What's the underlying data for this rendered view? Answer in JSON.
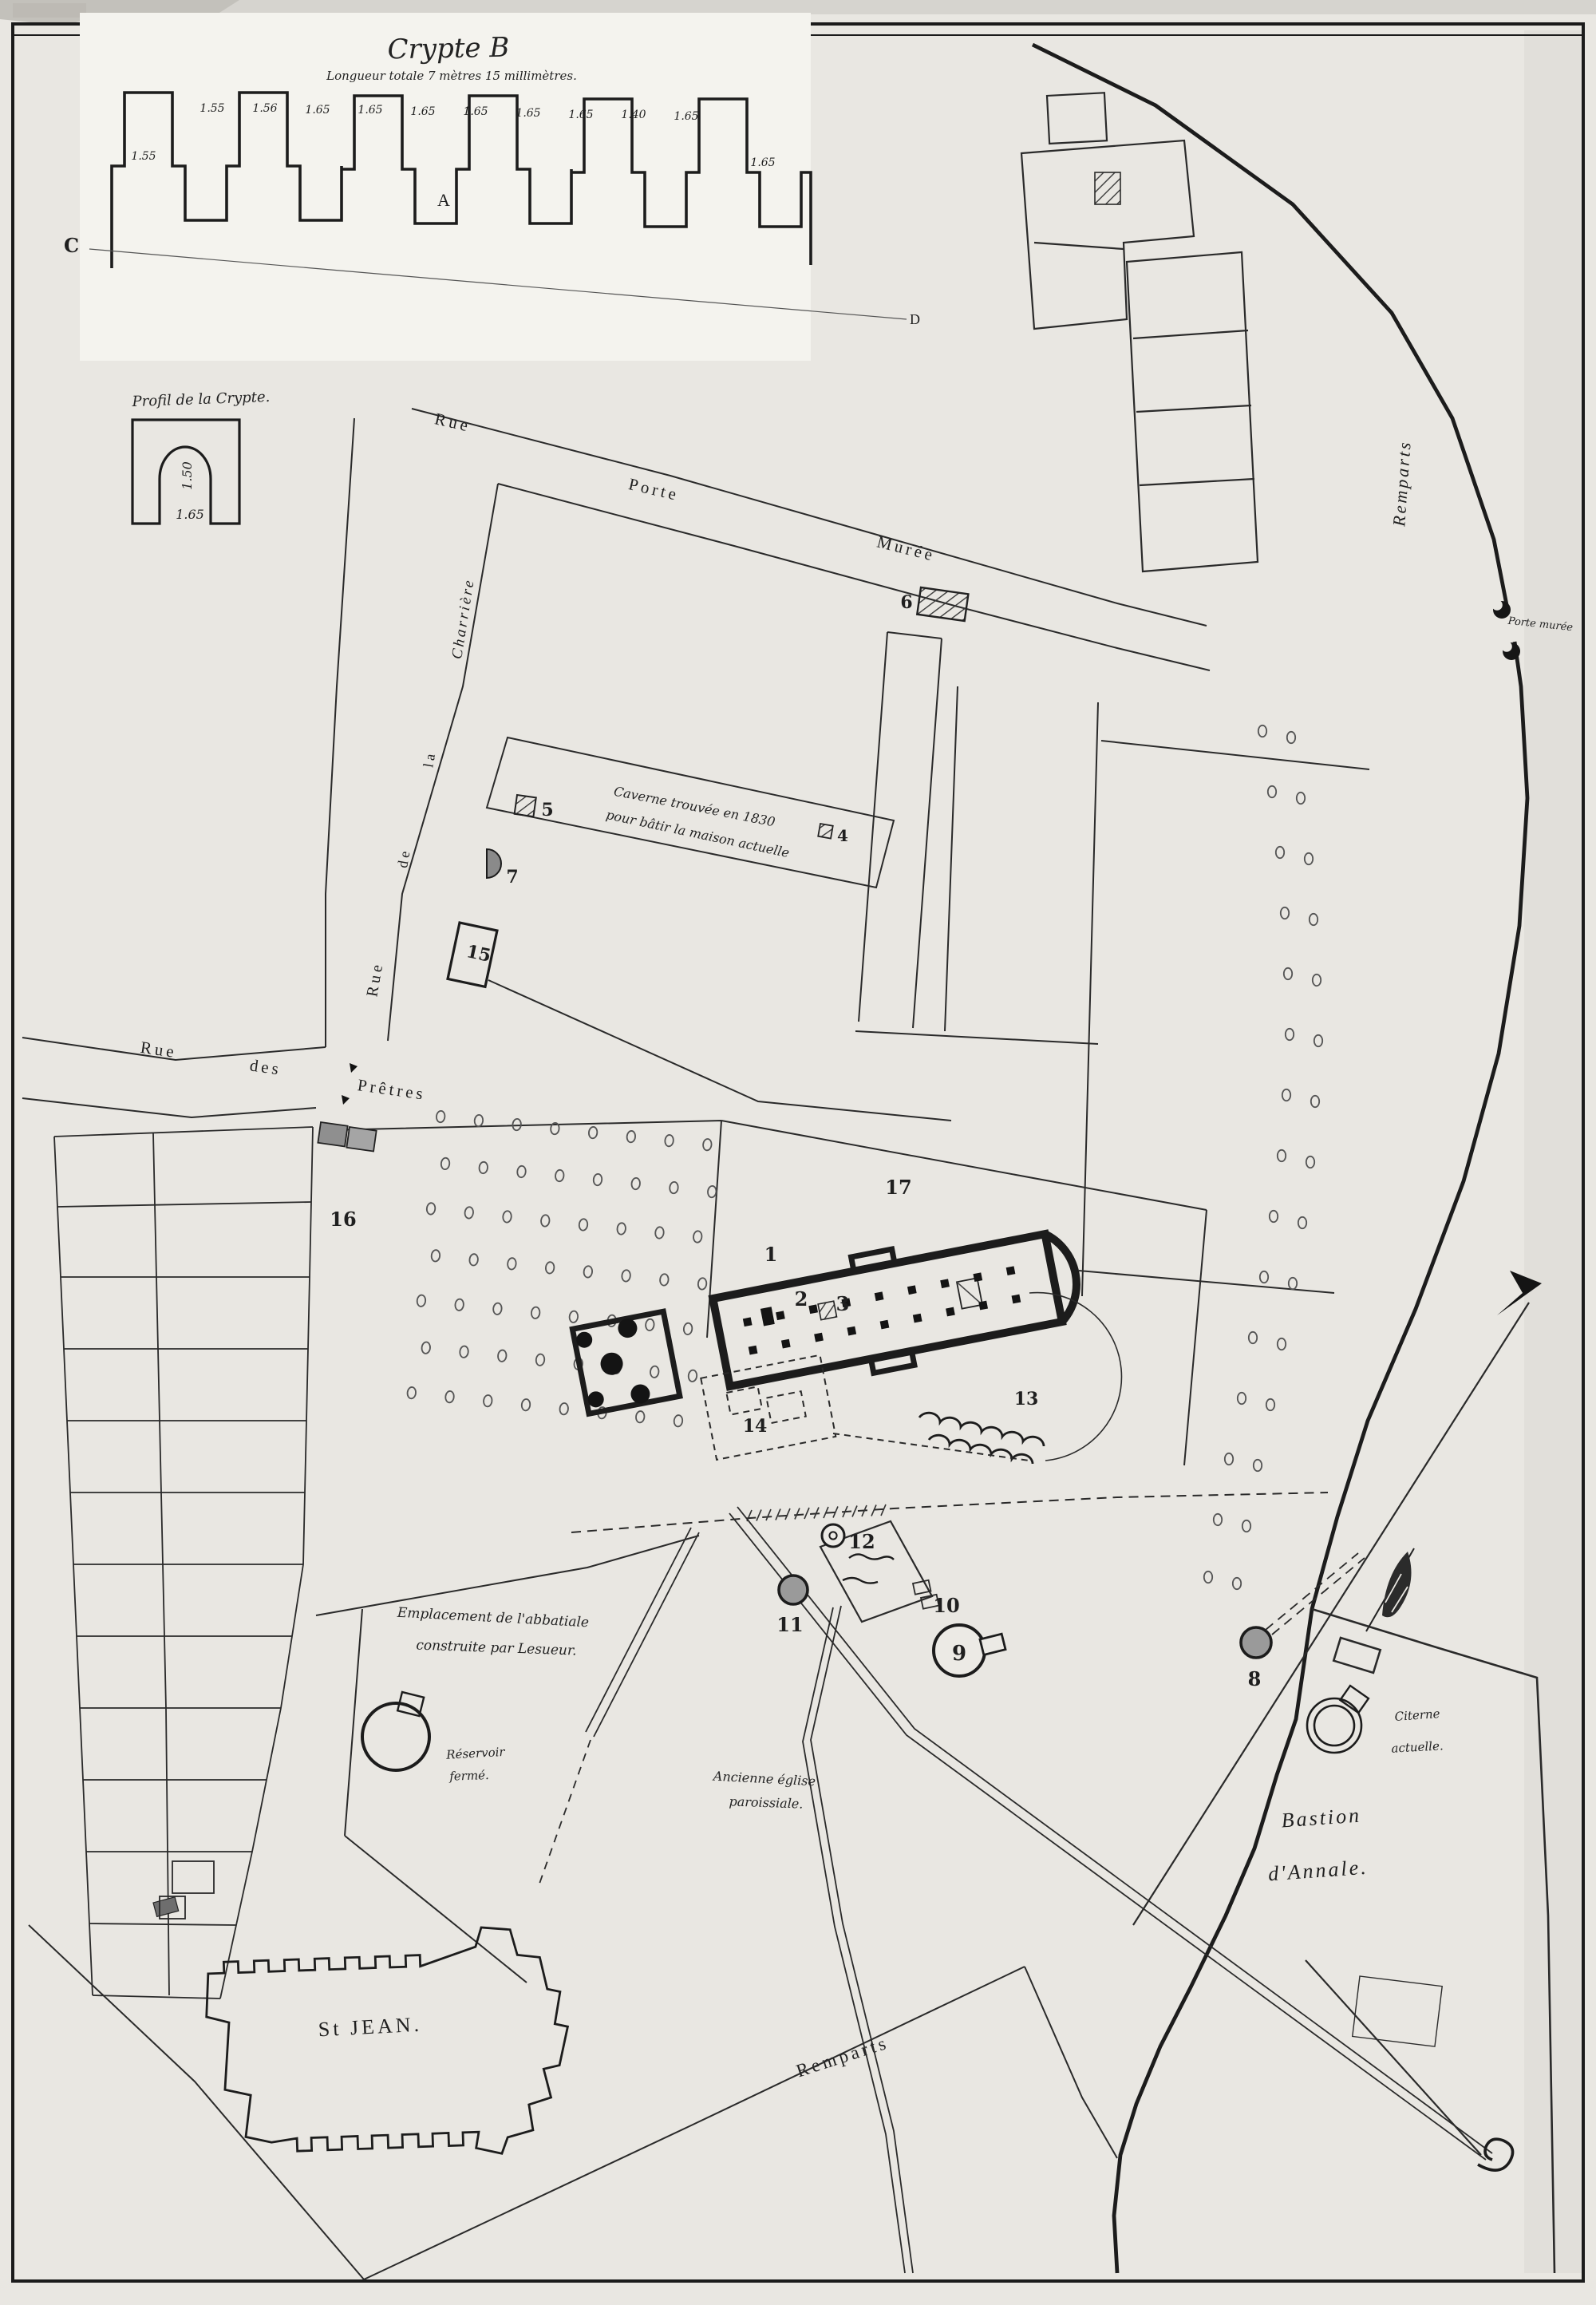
{
  "colors": {
    "paper": "#e9e7e2",
    "inset_paper": "#f4f3ee",
    "ink": "#1f1f1f",
    "gray_fill": "#8f8f8f"
  },
  "crypt_inset": {
    "title": "Crypte B",
    "subtitle": "Longueur totale 7 mètres 15 millimètres.",
    "plan_label": "A",
    "section_left": "C",
    "section_right": "D",
    "measure_far_left": "1.55",
    "measure_far_right": "1.65",
    "measurements": [
      "1.55",
      "1.56",
      "1.65",
      "1.65",
      "1.65",
      "1.65",
      "1.65",
      "1.65",
      "1.40",
      "1.65"
    ]
  },
  "profile_inset": {
    "label": "Profil de la Crypte.",
    "height_value": "1.50",
    "width_value": "1.65"
  },
  "streets": {
    "rue_porte_muree": [
      "Rue",
      "Porte",
      "Murée"
    ],
    "rue_de_la_charriere": [
      "Rue",
      "de",
      "la",
      "Charrière"
    ],
    "rue_des_pretres": [
      "Rue",
      "des",
      "Prêtres"
    ],
    "remparts_right": "Remparts",
    "remparts_bottom": "Remparts"
  },
  "annotations": {
    "caverne_line1": "Caverne trouvée en 1830",
    "caverne_line2": "pour bâtir la maison actuelle",
    "emplacement_line1": "Emplacement de l'abbatiale",
    "emplacement_line2": "construite par Lesueur.",
    "reservoir_line1": "Réservoir",
    "reservoir_line2": "fermé.",
    "ancienne_line1": "Ancienne église",
    "ancienne_line2": "paroissiale.",
    "porte_note": "Porte murée",
    "citerne_line1": "Citerne",
    "citerne_line2": "actuelle."
  },
  "places": {
    "st_jean": "St JEAN.",
    "bastion_line1": "Bastion",
    "bastion_line2": "d'Annale."
  },
  "markers": {
    "m1": "1",
    "m2": "2",
    "m3": "3",
    "m4": "4",
    "m5": "5",
    "m6": "6",
    "m7": "7",
    "m8": "8",
    "m9": "9",
    "m10": "10",
    "m11": "11",
    "m12": "12",
    "m13": "13",
    "m14": "14",
    "m15": "15",
    "m16": "16",
    "m17": "17"
  }
}
